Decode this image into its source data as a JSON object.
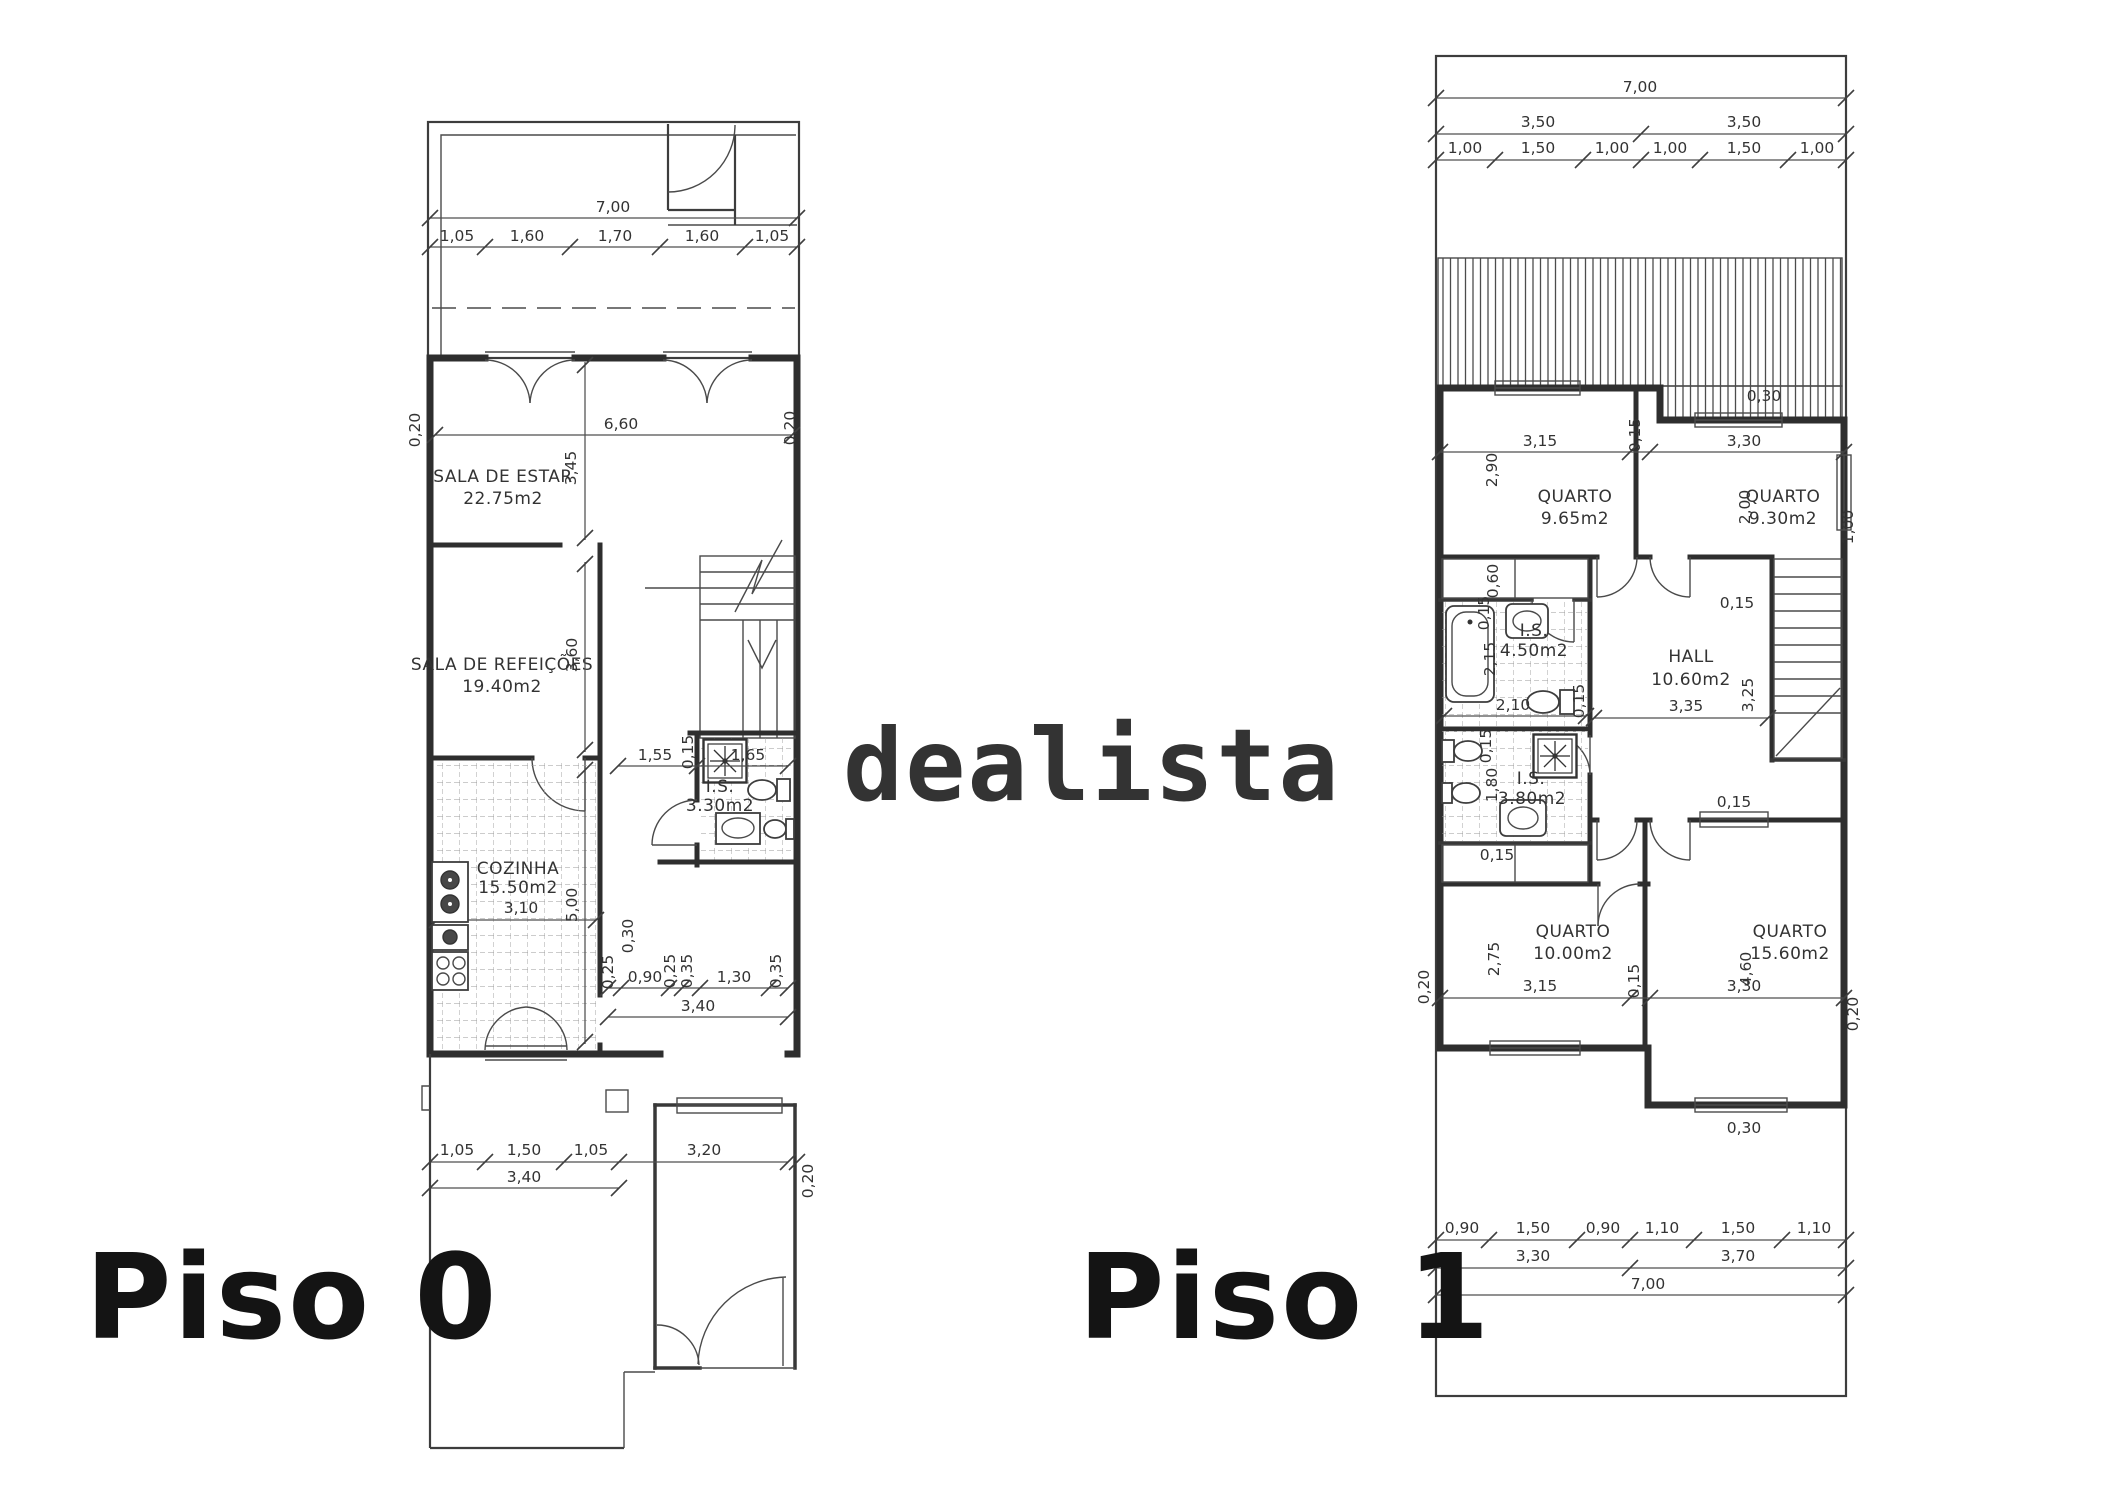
{
  "watermark": {
    "text": "dealista",
    "color": "#c3c3c3"
  },
  "floor0": {
    "label": "Piso 0",
    "rooms": {
      "estar": {
        "name": "SALA DE ESTAR",
        "area": "22.75m2"
      },
      "refeicoes": {
        "name": "SALA DE REFEIÇÕES",
        "area": "19.40m2"
      },
      "cozinha": {
        "name": "COZINHA",
        "area": "15.50m2"
      },
      "wc": {
        "name": "I.S.",
        "area": "3.30m2"
      }
    },
    "d": {
      "total": "7,00",
      "top": [
        "1,05",
        "1,60",
        "1,70",
        "1,60",
        "1,05"
      ],
      "estar_w": "6,60",
      "wall": "0,20",
      "estar_h": "3,45",
      "ref_h": "3,60",
      "is_line": [
        "1,55",
        "0,15",
        "1,65"
      ],
      "coz_w": "3,10",
      "coz_h": "5,00",
      "pass_side": "0,30",
      "passage": [
        "0,25",
        "0,90",
        "0,25",
        "0,35",
        "1,30",
        "0,35"
      ],
      "pass_total": "3,40",
      "bottom": [
        "1,05",
        "1,50",
        "1,05",
        "3,20"
      ],
      "bottom_total": "3,40",
      "bottom_wall": "0,20"
    }
  },
  "floor1": {
    "label": "Piso 1",
    "rooms": {
      "q1": {
        "name": "QUARTO",
        "area": "9.65m2"
      },
      "q2": {
        "name": "QUARTO",
        "area": "9.30m2"
      },
      "q3": {
        "name": "QUARTO",
        "area": "10.00m2"
      },
      "q4": {
        "name": "QUARTO",
        "area": "15.60m2"
      },
      "hall": {
        "name": "HALL",
        "area": "10.60m2"
      },
      "wc1": {
        "name": "I.S.",
        "area": "4.50m2"
      },
      "wc2": {
        "name": "I.S.",
        "area": "3.80m2"
      }
    },
    "d": {
      "total": "7,00",
      "half_l": "3,50",
      "half_r": "3,50",
      "top": [
        "1,00",
        "1,50",
        "1,00",
        "1,00",
        "1,50",
        "1,00"
      ],
      "roof_win": "0,30",
      "q1w": "3,15",
      "midwall": "0,15",
      "q2w": "3,30",
      "q1h": "2,90",
      "q2h": "2,00",
      "closet1": "0,60",
      "is1_n": "0,15",
      "is1_h": "2,15",
      "is1_w": "2,10",
      "is1_wall": "0,15",
      "hallw": "3,35",
      "hallh": "3,25",
      "hall_n": "0,15",
      "stairs": "1,00",
      "hall_door": "0,15",
      "is2_n": "0,15",
      "is2_h": "1,80",
      "closet2": "0,15",
      "q3h": "2,75",
      "q3w": "3,15",
      "midwall2": "0,15",
      "q4w": "3,30",
      "q4h": "4,60",
      "wall_l": "0,20",
      "wall_r": "0,20",
      "q4_win": "0,30",
      "bottom": [
        "0,90",
        "1,50",
        "0,90",
        "1,10",
        "1,50",
        "1,10"
      ],
      "bh_l": "3,30",
      "bh_r": "3,70",
      "total_b": "7,00"
    }
  }
}
